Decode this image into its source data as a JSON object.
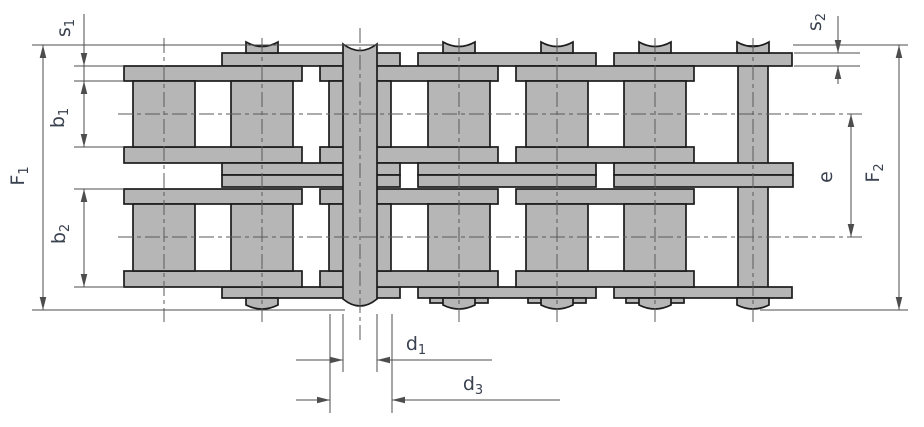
{
  "figure": {
    "background": "#ffffff",
    "part_fill": "#b6b6b6",
    "part_outline": "#1c1c1c",
    "dim_line": "#4d4d4d",
    "centerline": "#5a5a5a",
    "label_color": "#3a4250"
  },
  "drawing_title": "duplex-roller-chain-dimension-drawing",
  "labels": {
    "s1": {
      "base": "s",
      "sub": "1"
    },
    "b1": {
      "base": "b",
      "sub": "1"
    },
    "f1": {
      "base": "F",
      "sub": "1"
    },
    "b2": {
      "base": "b",
      "sub": "2"
    },
    "s2": {
      "base": "s",
      "sub": "2"
    },
    "e": {
      "base": "e",
      "sub": ""
    },
    "f2": {
      "base": "F",
      "sub": "2"
    },
    "d1": {
      "base": "d",
      "sub": "1"
    },
    "d3": {
      "base": "d",
      "sub": "3"
    }
  }
}
